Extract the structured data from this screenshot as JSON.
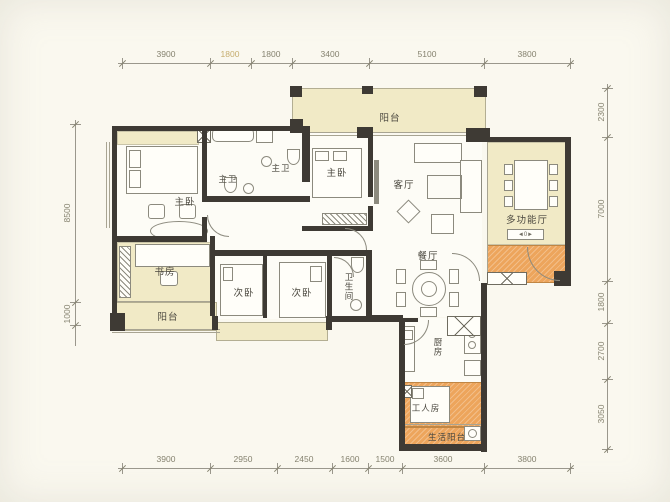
{
  "dims": {
    "top": [
      "3900",
      "1800",
      "1800",
      "3400",
      "5100",
      "3800"
    ],
    "bottom": [
      "3900",
      "2950",
      "2450",
      "1600",
      "1500",
      "3600",
      "3800"
    ],
    "left": [
      "8500",
      "1000"
    ],
    "right": [
      "2300",
      "7000",
      "1800",
      "2700",
      "3050"
    ]
  },
  "rooms": {
    "balcony_top": "阳台",
    "master1": "主卧",
    "master_bath_a": "主卫",
    "master_bath_b": "主卫",
    "master2": "主卧",
    "living": "客厅",
    "multi": "多功能厅",
    "dining": "餐厅",
    "study": "书房",
    "balcony_left": "阳台",
    "bedroom_a": "次卧",
    "bedroom_b": "次卧",
    "bathroom": "卫生间",
    "kitchen": "厨房",
    "maid": "工人房",
    "service_balcony": "生活阳台"
  },
  "icons": {
    "sideboard": "◄0►"
  },
  "colors": {
    "background": "#faf8ef",
    "room_cream": "#f1eac6",
    "highlight_orange": "#eda55c",
    "wall": "#3e3a34",
    "dim_text": "#85826f",
    "dim_text_highlight": "#c6ad6e",
    "label_text": "#4a473e"
  }
}
